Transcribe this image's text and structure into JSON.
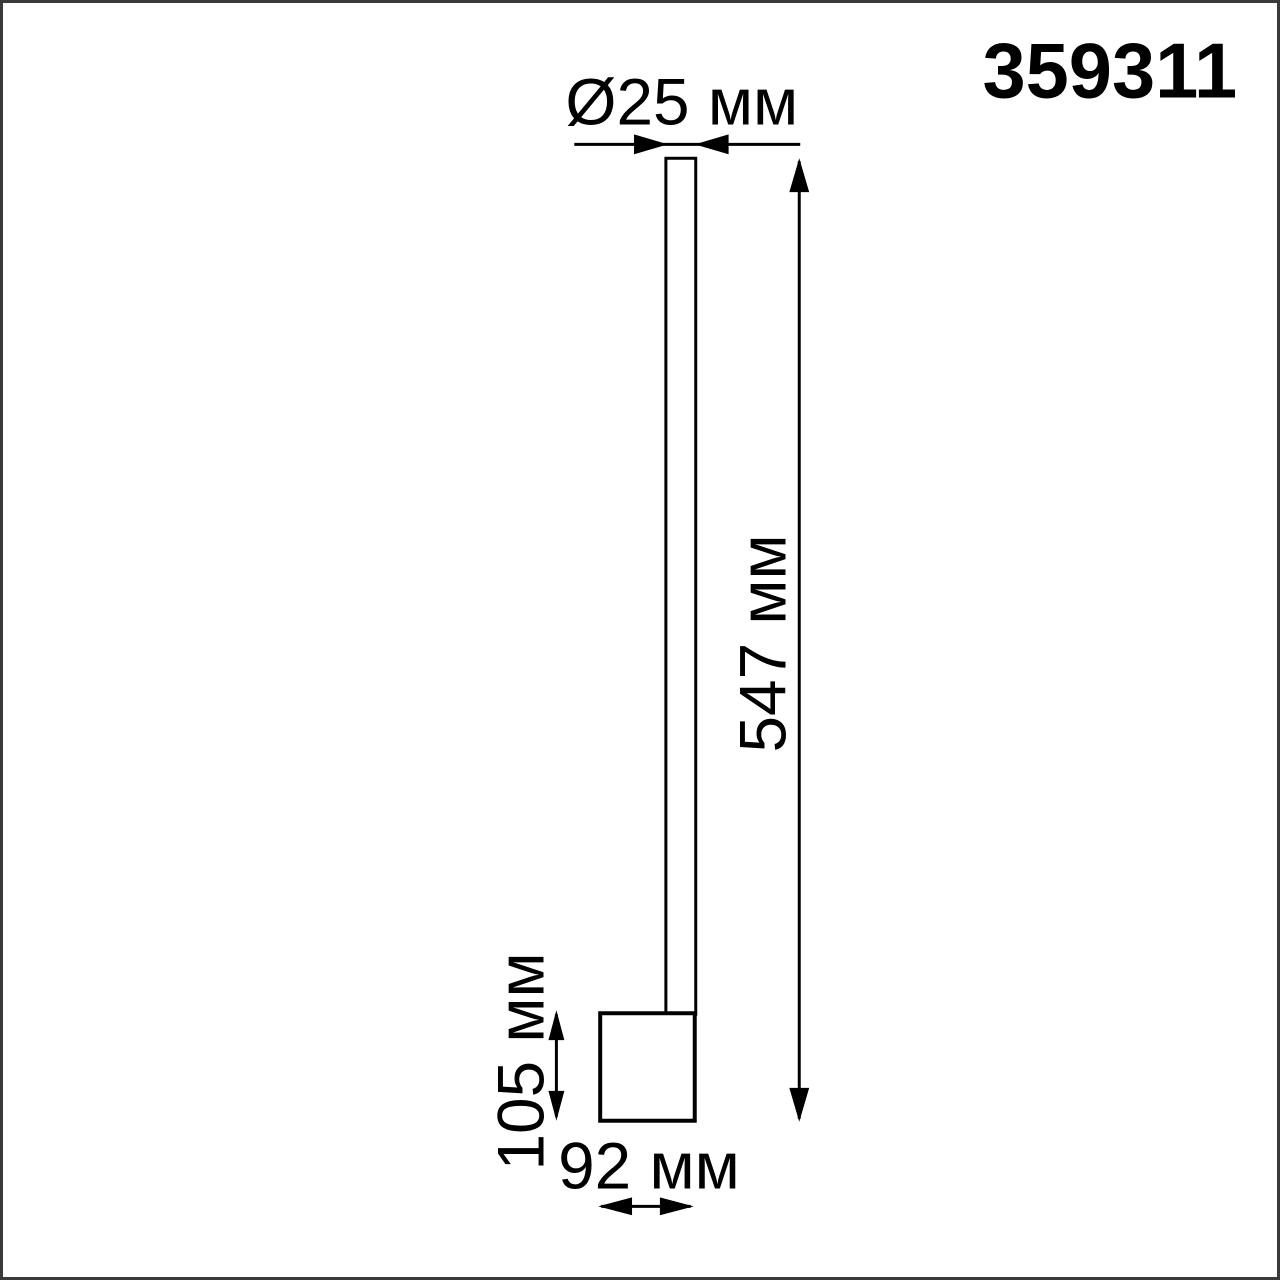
{
  "page": {
    "background_color": "#ffffff",
    "frame_color": "#3a3a3a",
    "line_color": "#000000",
    "text_color": "#000000"
  },
  "diagram": {
    "part_number": "359311",
    "dimensions": {
      "diameter": "Ø25 мм",
      "height": "547 мм",
      "base_height": "105 мм",
      "base_width": "92 мм"
    }
  }
}
